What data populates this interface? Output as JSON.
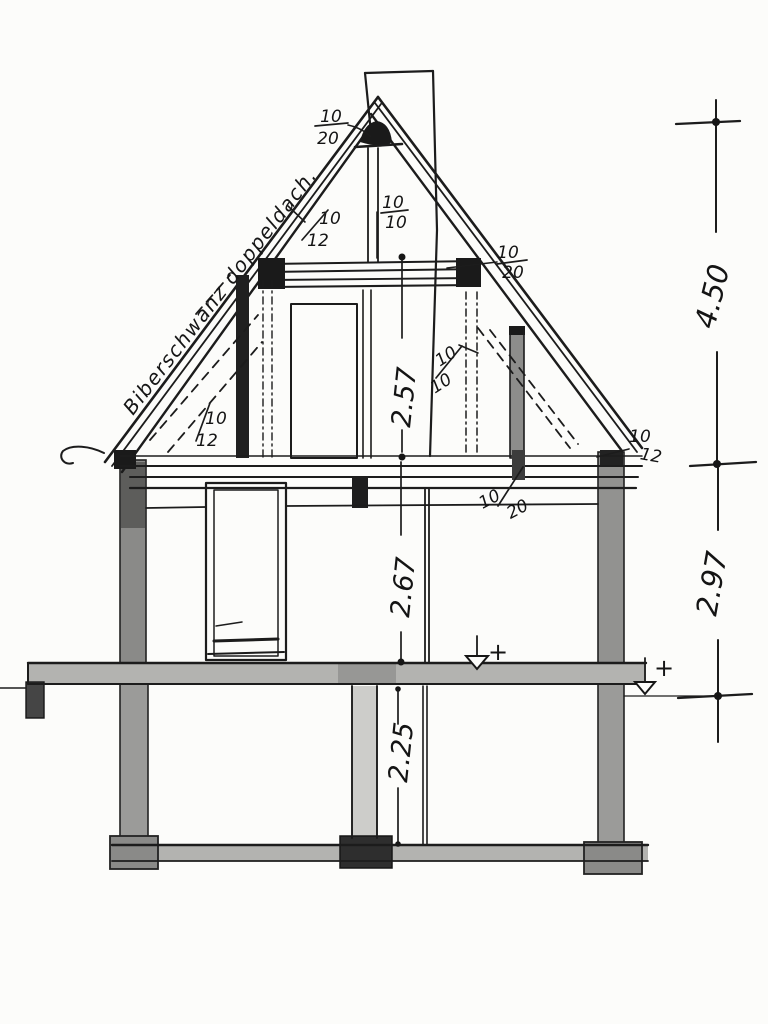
{
  "drawing": {
    "roof_label": "Biberschwanz doppeldach.",
    "dims": {
      "attic": "2.57",
      "upper_floor": "2.67",
      "basement": "2.25",
      "roof_zone": "4.50",
      "floor_zone": "2.97"
    },
    "pitch": {
      "peak": {
        "num": "10",
        "den": "20"
      },
      "left_upper": {
        "num": "10",
        "den": "12"
      },
      "center": {
        "num": "10",
        "den": "10"
      },
      "right_collar": {
        "num": "10",
        "den": "20"
      },
      "right_mid": {
        "num": "10",
        "den": "10"
      },
      "left_lower": {
        "num": "10",
        "den": "12"
      },
      "attic_floor": {
        "num": "10",
        "den": "20"
      },
      "right_eave": {
        "num": "10",
        "den": "12"
      }
    },
    "markers": {
      "plus_upper": "+",
      "plus_ground": "+"
    }
  }
}
